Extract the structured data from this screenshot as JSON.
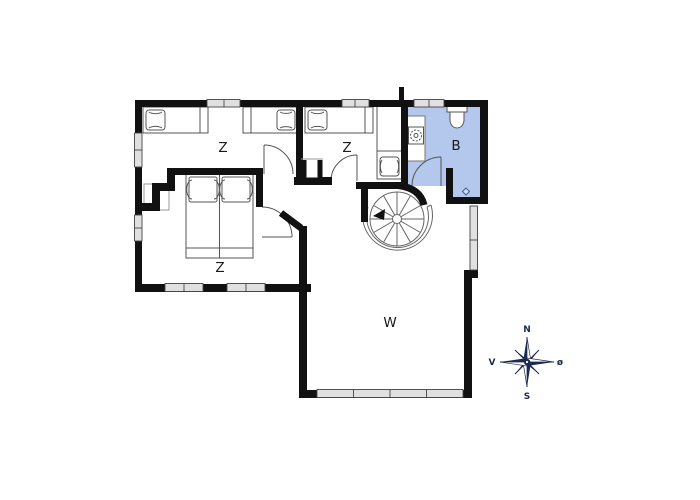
{
  "floorplan": {
    "type": "house-floor-plan",
    "rooms": {
      "bedroom_top_left": {
        "label": "Z"
      },
      "bedroom_top_middle": {
        "label": "Z"
      },
      "bedroom_bottom_left": {
        "label": "Z"
      },
      "bathroom": {
        "label": "B"
      },
      "living_room": {
        "label": "W"
      }
    },
    "colors": {
      "bathroom_fill": "#b3c8ec",
      "wall": "#111111",
      "window_fill": "#e0e0e0",
      "furniture_line": "#555555"
    }
  },
  "compass": {
    "north": "N",
    "south": "S",
    "west": "V",
    "east": "ø",
    "color": "#1d2b50"
  }
}
